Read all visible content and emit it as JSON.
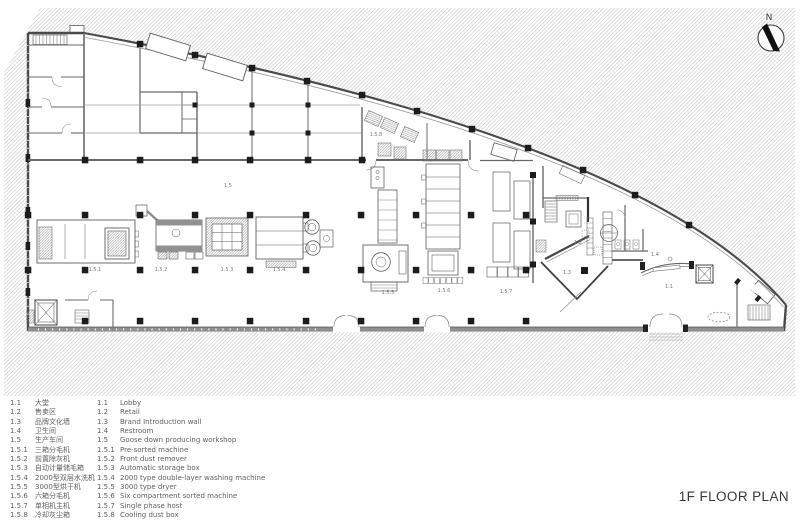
{
  "title": {
    "text": "1F FLOOR PLAN"
  },
  "north_arrow": {
    "label": "N"
  },
  "colors": {
    "hatch_line": "#bcbcbc",
    "wall": "#4a4a4a",
    "column": "#1c1c1c",
    "plan_label_text": "#787878",
    "legend_text": "#5f5f5f"
  },
  "plan": {
    "labels": [
      {
        "text": "1.5"
      },
      {
        "text": "1.5.1"
      },
      {
        "text": "1.5.2"
      },
      {
        "text": "1.5.3"
      },
      {
        "text": "1.5.4"
      },
      {
        "text": "1.5.5"
      },
      {
        "text": "1.5.6"
      },
      {
        "text": "1.5.7"
      },
      {
        "text": "1.5.8"
      },
      {
        "text": "1.1"
      },
      {
        "text": "1.2"
      },
      {
        "text": "1.3"
      },
      {
        "text": "1.4"
      }
    ]
  },
  "legend": {
    "items": [
      {
        "num": "1.1",
        "zh": "大堂",
        "en": "Lobby"
      },
      {
        "num": "1.2",
        "zh": "售卖区",
        "en": "Retail"
      },
      {
        "num": "1.3",
        "zh": "品牌文化墙",
        "en": "Brand Introduction wall"
      },
      {
        "num": "1.4",
        "zh": "卫生间",
        "en": "Restroom"
      },
      {
        "num": "1.5",
        "zh": "生产车间",
        "en": "Goose down producing workshop"
      },
      {
        "num": "1.5.1",
        "zh": "三箱分毛机",
        "en": "Pre-sorted  machine"
      },
      {
        "num": "1.5.2",
        "zh": "前置除灰机",
        "en": "Front dust remover"
      },
      {
        "num": "1.5.3",
        "zh": "自动计量储毛箱",
        "en": "Automatic storage box"
      },
      {
        "num": "1.5.4",
        "zh": "2000型双层水洗机",
        "en": "2000 type double-layer washing machine"
      },
      {
        "num": "1.5.5",
        "zh": "3000型烘干机",
        "en": "3000 type dryer"
      },
      {
        "num": "1.5.6",
        "zh": "六箱分毛机",
        "en": "Six compartment sorted  machine"
      },
      {
        "num": "1.5.7",
        "zh": "单相机主机",
        "en": "Single phase host"
      },
      {
        "num": "1.5.8",
        "zh": "冷却灰尘箱",
        "en": "Cooling dust box"
      }
    ]
  }
}
